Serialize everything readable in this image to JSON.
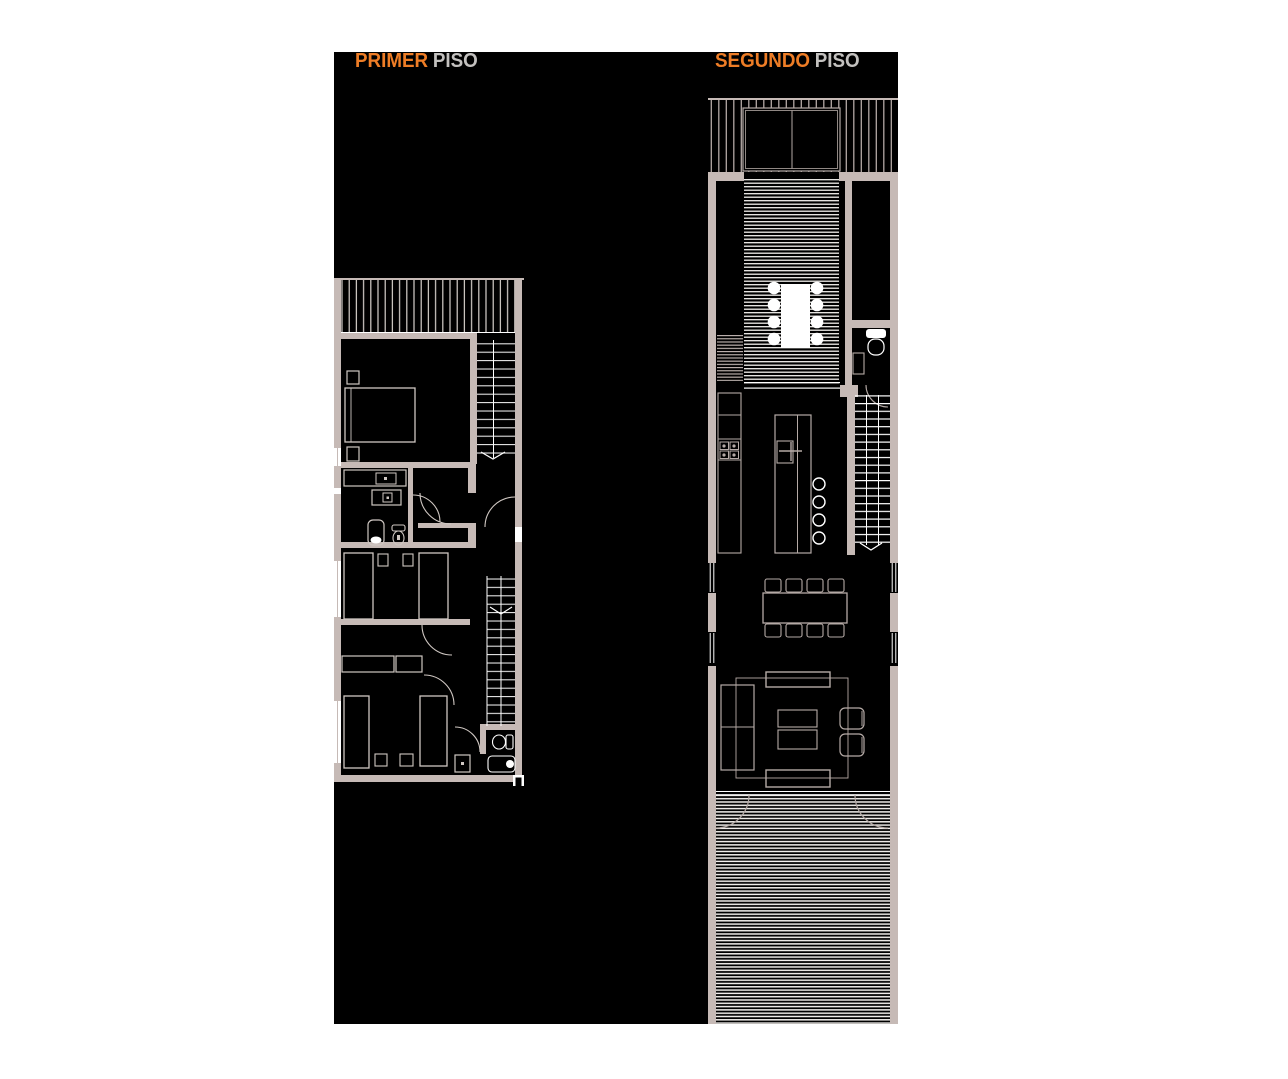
{
  "titles": {
    "floor1": {
      "accent": "PRIMER",
      "rest": "PISO"
    },
    "floor2": {
      "accent": "SEGUNDO",
      "rest": "PISO"
    }
  },
  "palette": {
    "page_bg": "#ffffff",
    "canvas_bg": "#000000",
    "accent": "#ee7d26",
    "title_gray": "#c3c1bf",
    "wall": "#c6bab6",
    "furn1": "#cfc7c2",
    "furn2": "#b5aaa6",
    "hatch1": "#d8d2cd",
    "hatch2": "#b3a8a4",
    "deckline": "#f3f0ed",
    "louver": "#c0b5b1",
    "white": "#ffffff"
  }
}
